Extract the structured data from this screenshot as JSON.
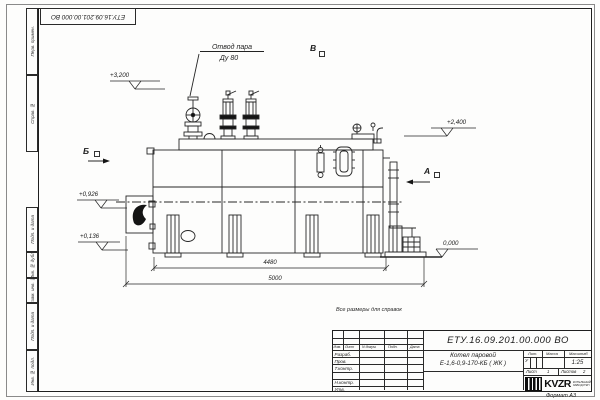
{
  "sheet": {
    "top_stamp": "ЕТУ.16.09.201.00.000 ВО",
    "left_labels": [
      "Перв. примен.",
      "Справ. №",
      "Подп. и дата",
      "Инв. № дубл.",
      "Взам. инв. №",
      "Подп. и дата",
      "Инв. № подл."
    ],
    "format_note": "Формат А3"
  },
  "drawing": {
    "note": "Все размеры для справок",
    "callout_line1": "Отвод пара",
    "callout_line2": "Ду 80",
    "view_b": "Б",
    "view_a": "А",
    "view_v": "В",
    "elevations": [
      "+3,200",
      "+2,400",
      "+0,926",
      "+0,136",
      "0,000"
    ],
    "dim_inner": "4480",
    "dim_outer": "5000"
  },
  "title_block": {
    "doc_number": "ЕТУ.16.09.201.00.000  ВО",
    "name_line1": "Котел паровой",
    "name_line2": "Е-1,6-0,9-170-КБ ( ЖК )",
    "cols": {
      "izm": "Изм.",
      "list": "Лист",
      "ndoc": "N докум.",
      "podp": "Подп.",
      "data": "Дата"
    },
    "rows": [
      "Разраб.",
      "Пров.",
      "Т.контр.",
      "Н.контр.",
      "Утв."
    ],
    "lit_label": "Лит.",
    "lit_value": "У",
    "mass_label": "Масса",
    "scale_label": "Масштаб",
    "scale_value": "1:25",
    "sheet_label": "Лист",
    "sheet_value": "1",
    "sheets_label": "Листов",
    "sheets_value": "2",
    "logo_text": "KVZR",
    "logo_sub1": "КОТЕЛЬНЫЙ",
    "logo_sub2": "ЗАВОД РЭП"
  }
}
